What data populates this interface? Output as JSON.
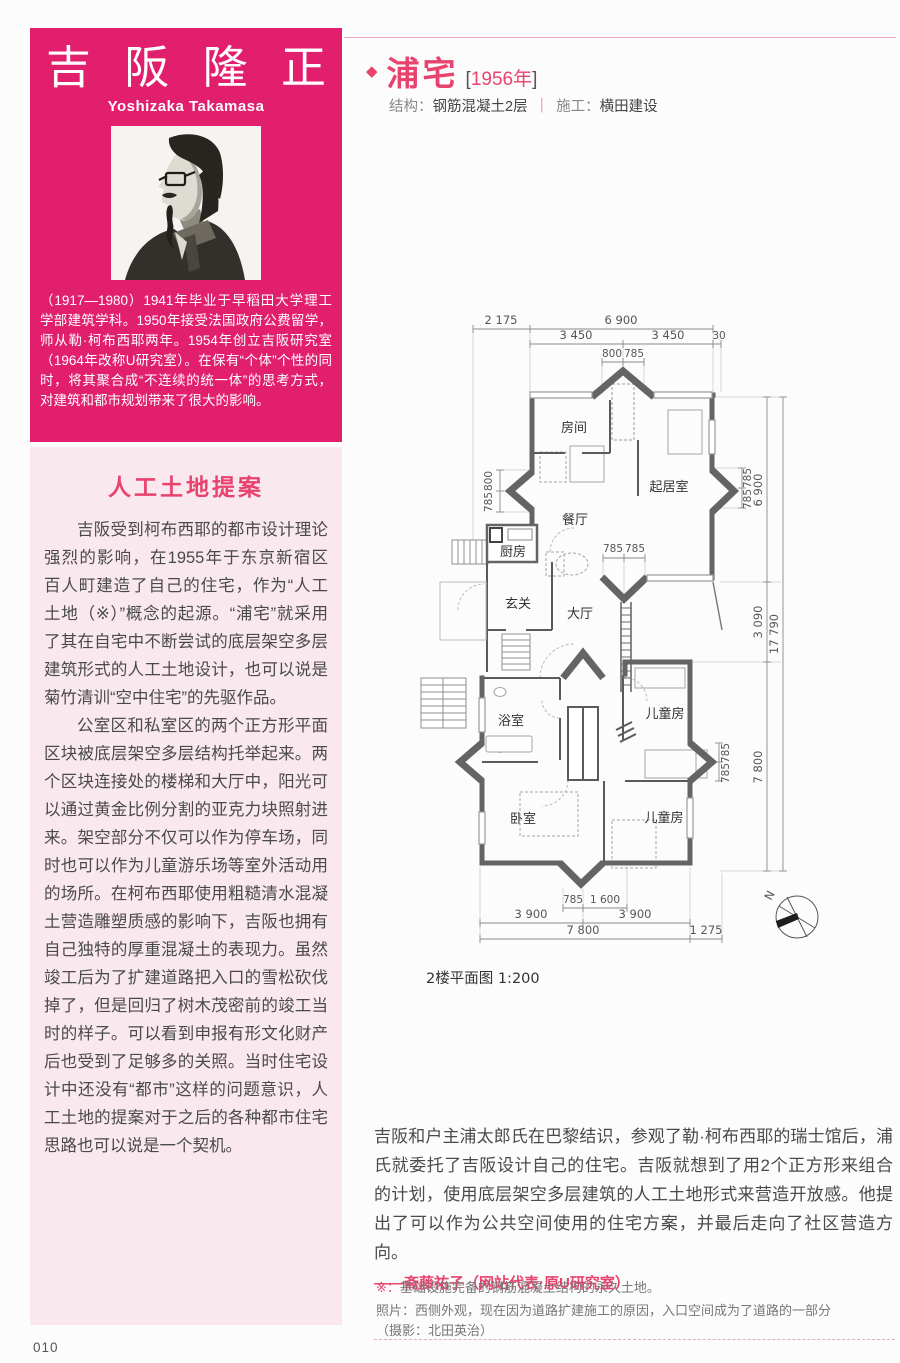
{
  "colors": {
    "accent_pink": "#e11f6d",
    "panel_pink": "#f9e8ee",
    "heading_pink": "#e8436f",
    "text_dark": "#4a4a4a",
    "wall_gray": "#646464"
  },
  "sidebar": {
    "name_chars": [
      "吉",
      "阪",
      "隆",
      "正"
    ],
    "architect_name": "吉阪隆正",
    "romanized": "Yoshizaka Takamasa",
    "bio": "（1917—1980）1941年毕业于早稻田大学理工学部建筑学科。1950年接受法国政府公费留学，师从勒·柯布西耶两年。1954年创立吉阪研究室（1964年改称U研究室）。在保有“个体”个性的同时，将其聚合成“不连续的统一体”的思考方式，对建筑和都市规划带来了很大的影响。",
    "section_title": "人工土地提案",
    "para1": "吉阪受到柯布西耶的都市设计理论强烈的影响，在1955年于东京新宿区百人町建造了自己的住宅，作为“人工土地（※）”概念的起源。“浦宅”就采用了其在自宅中不断尝试的底层架空多层建筑形式的人工土地设计，也可以说是菊竹清训“空中住宅”的先驱作品。",
    "para2": "公室区和私室区的两个正方形平面区块被底层架空多层结构托举起来。两个区块连接处的楼梯和大厅中，阳光可以通过黄金比例分割的亚克力块照射进来。架空部分不仅可以作为停车场，同时也可以作为儿童游乐场等室外活动用的场所。在柯布西耶使用粗糙清水混凝土营造雕塑质感的影响下，吉阪也拥有自己独特的厚重混凝土的表现力。虽然竣工后为了扩建道路把入口的雪松砍伐掉了，但是回归了树木茂密前的竣工当时的样子。可以看到申报有形文化财产后也受到了足够多的关照。当时住宅设计中还没有“都市”这样的问题意识，人工土地的提案对于之后的各种都市住宅思路也可以说是一个契机。"
  },
  "project": {
    "bullet": "◆",
    "title": "浦宅",
    "bracket_open": "[",
    "year": "1956年",
    "bracket_close": "]",
    "spec_structure_label": "结构：",
    "spec_structure": "钢筋混凝土2层",
    "divider": "｜",
    "spec_builder_label": "施工：",
    "spec_builder": "横田建设"
  },
  "plan": {
    "caption": "2楼平面图 1:200",
    "north": "N",
    "labels": {
      "room": "房间",
      "living": "起居室",
      "dining": "餐厅",
      "kitchen": "厨房",
      "entry": "玄关",
      "hall": "大厅",
      "bath": "浴室",
      "child_top": "儿童房",
      "bedroom": "卧室",
      "child_bottom": "儿童房"
    },
    "dims": {
      "t2175": "2 175",
      "t6900": "6 900",
      "t3450a": "3 450",
      "t3450b": "3 450",
      "t30": "30",
      "t800": "800",
      "t785": "785",
      "l800": "800",
      "l785": "785",
      "c785a": "785",
      "c785b": "785",
      "r785a": "785",
      "r785b": "785",
      "r6900": "6 900",
      "r3090": "3 090",
      "r17790": "17 790",
      "r785c": "785",
      "r785d": "785",
      "r7800": "7 800",
      "b785": "785",
      "b1600": "1 600",
      "b3900a": "3 900",
      "b3900b": "3 900",
      "b7800": "7 800",
      "b1275": "1 275"
    }
  },
  "body": {
    "paragraph": "吉阪和户主浦太郎氏在巴黎结识，参观了勒·柯布西耶的瑞士馆后，浦氏就委托了吉阪设计自己的住宅。吉阪就想到了用2个正方形来组合的计划，使用底层架空多层建筑的人工土地形式来营造开放感。他提出了可以作为公共空间使用的住宅方案，并最后走向了社区营造方向。",
    "attribution": "——斋藤祐子（网站代表·原U研究室）",
    "footnote_marker": "※：",
    "footnote": "基础设施完备的钢筋混凝土结构的永久土地。",
    "photo_note1": "照片：西侧外观，现在因为道路扩建施工的原因，入口空间成为了道路的一部分",
    "photo_note2": "（摄影：北田英治）"
  },
  "page": {
    "number": "010"
  }
}
